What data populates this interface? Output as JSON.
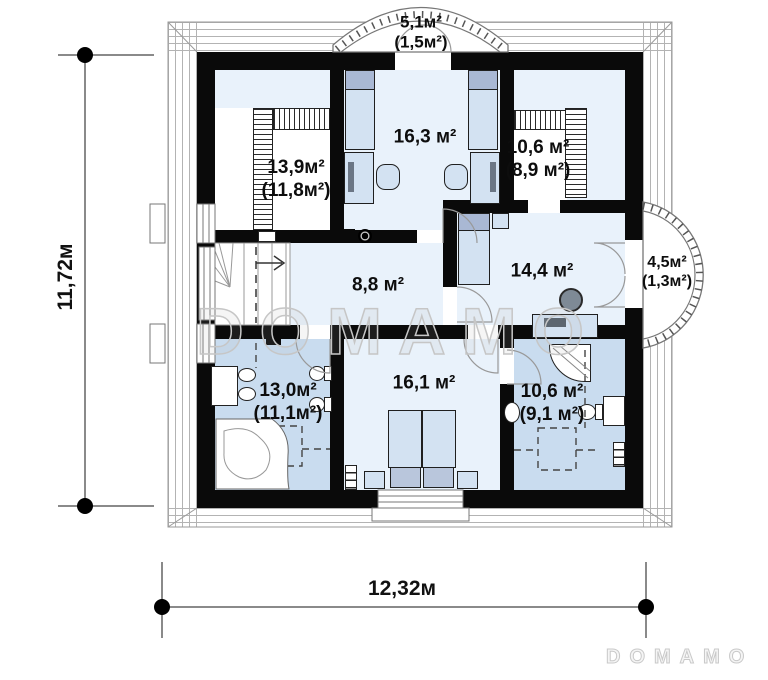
{
  "title": "Second floor plan",
  "rooms": [
    {
      "name": "balcony-top",
      "area": "5,1м²",
      "reduced": "(1,5м²)"
    },
    {
      "name": "bedroom-top-left",
      "area": "13,9м²",
      "reduced": "(11,8м²)"
    },
    {
      "name": "bedroom-top-center",
      "area": "16,3 м²",
      "reduced": ""
    },
    {
      "name": "bedroom-top-right",
      "area": "10,6 м²",
      "reduced": "(8,9 м²)"
    },
    {
      "name": "hall",
      "area": "8,8 м²",
      "reduced": ""
    },
    {
      "name": "bedroom-middle-right",
      "area": "14,4 м²",
      "reduced": ""
    },
    {
      "name": "balcony-right",
      "area": "4,5м²",
      "reduced": "(1,3м²)"
    },
    {
      "name": "bathroom-left",
      "area": "13,0м²",
      "reduced": "(11,1м²)"
    },
    {
      "name": "bedroom-bottom-center",
      "area": "16,1 м²",
      "reduced": ""
    },
    {
      "name": "bathroom-right",
      "area": "10,6 м²",
      "reduced": "(9,1 м²)"
    }
  ],
  "dimensions": {
    "height": "11,72м",
    "width": "12,32м"
  },
  "watermark": {
    "center": "DOMAMO",
    "corner": "DOMAMO"
  },
  "colors": {
    "wall": "#0a0a0a",
    "room": "#e9f2fb",
    "wet": "#c9dcef",
    "furniture": "#d3e2f2",
    "pillow": "#a9b8d4"
  }
}
